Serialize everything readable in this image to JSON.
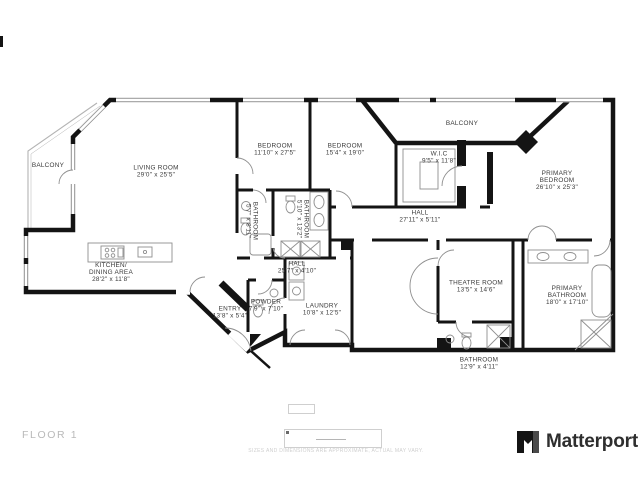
{
  "floor": {
    "label": "FLOOR 1"
  },
  "disclaimer": "SIZES AND DIMENSIONS ARE APPROXIMATE, ACTUAL MAY VARY.",
  "brand": {
    "name": "Matterport",
    "icon": "matterport-m-icon"
  },
  "colors": {
    "wall": "#141414",
    "fixture": "#8f8f8f",
    "label": "#3a3a3a",
    "muted": "#b9b9b9",
    "faint": "#cfcfcf",
    "balcony": "#b3b3b3"
  },
  "rooms": [
    {
      "id": "balcony-left",
      "lines": [
        "BALCONY"
      ],
      "x": 48,
      "y": 165,
      "rotate": 0
    },
    {
      "id": "living-room",
      "lines": [
        "LIVING ROOM",
        "29'0\" x 25'5\""
      ],
      "x": 156,
      "y": 171,
      "rotate": 0
    },
    {
      "id": "bedroom-1",
      "lines": [
        "BEDROOM",
        "11'10\" x 27'5\""
      ],
      "x": 275,
      "y": 149,
      "rotate": 0
    },
    {
      "id": "bedroom-2",
      "lines": [
        "BEDROOM",
        "15'4\" x 19'0\""
      ],
      "x": 345,
      "y": 149,
      "rotate": 0
    },
    {
      "id": "balcony-top",
      "lines": [
        "BALCONY"
      ],
      "x": 462,
      "y": 123,
      "rotate": 0
    },
    {
      "id": "wic",
      "lines": [
        "W.I.C",
        "9'5\" x 11'8\""
      ],
      "x": 439,
      "y": 157,
      "rotate": 0
    },
    {
      "id": "primary-bedroom",
      "lines": [
        "PRIMARY",
        "BEDROOM",
        "26'10\" x 25'3\""
      ],
      "x": 557,
      "y": 180,
      "rotate": 0
    },
    {
      "id": "hall-upper",
      "lines": [
        "HALL",
        "27'11\" x 5'11\""
      ],
      "x": 420,
      "y": 216,
      "rotate": 0
    },
    {
      "id": "bathroom-small-1",
      "lines": [
        "BATHROOM",
        "5'7\" x 8'11\""
      ],
      "x": 252,
      "y": 221,
      "rotate": 90
    },
    {
      "id": "bathroom-small-2",
      "lines": [
        "BATHROOM",
        "5'10\" x 13'2\""
      ],
      "x": 303,
      "y": 219,
      "rotate": 90
    },
    {
      "id": "kitchen-dining",
      "lines": [
        "KITCHEN/",
        "DINING AREA",
        "28'2\" x 11'8\""
      ],
      "x": 111,
      "y": 272,
      "rotate": 0
    },
    {
      "id": "hall-lower",
      "lines": [
        "HALL",
        "25'7\" x 4'10\""
      ],
      "x": 297,
      "y": 267,
      "rotate": 0
    },
    {
      "id": "entry",
      "lines": [
        "ENTRY",
        "13'8\" x 5'4\""
      ],
      "x": 230,
      "y": 312,
      "rotate": 0
    },
    {
      "id": "powder",
      "lines": [
        "POWDER",
        "7'9\" x 7'10\""
      ],
      "x": 266,
      "y": 305,
      "rotate": 0
    },
    {
      "id": "laundry",
      "lines": [
        "LAUNDRY",
        "10'8\" x 12'5\""
      ],
      "x": 322,
      "y": 309,
      "rotate": 0
    },
    {
      "id": "theatre-room",
      "lines": [
        "THEATRE ROOM",
        "13'5\" x 14'6\""
      ],
      "x": 476,
      "y": 286,
      "rotate": 0
    },
    {
      "id": "primary-bathroom",
      "lines": [
        "PRIMARY",
        "BATHROOM",
        "18'0\" x 17'10\""
      ],
      "x": 567,
      "y": 295,
      "rotate": 0
    },
    {
      "id": "bathroom-bottom",
      "lines": [
        "BATHROOM",
        "12'9\" x 4'11\""
      ],
      "x": 479,
      "y": 363,
      "rotate": 0
    }
  ]
}
